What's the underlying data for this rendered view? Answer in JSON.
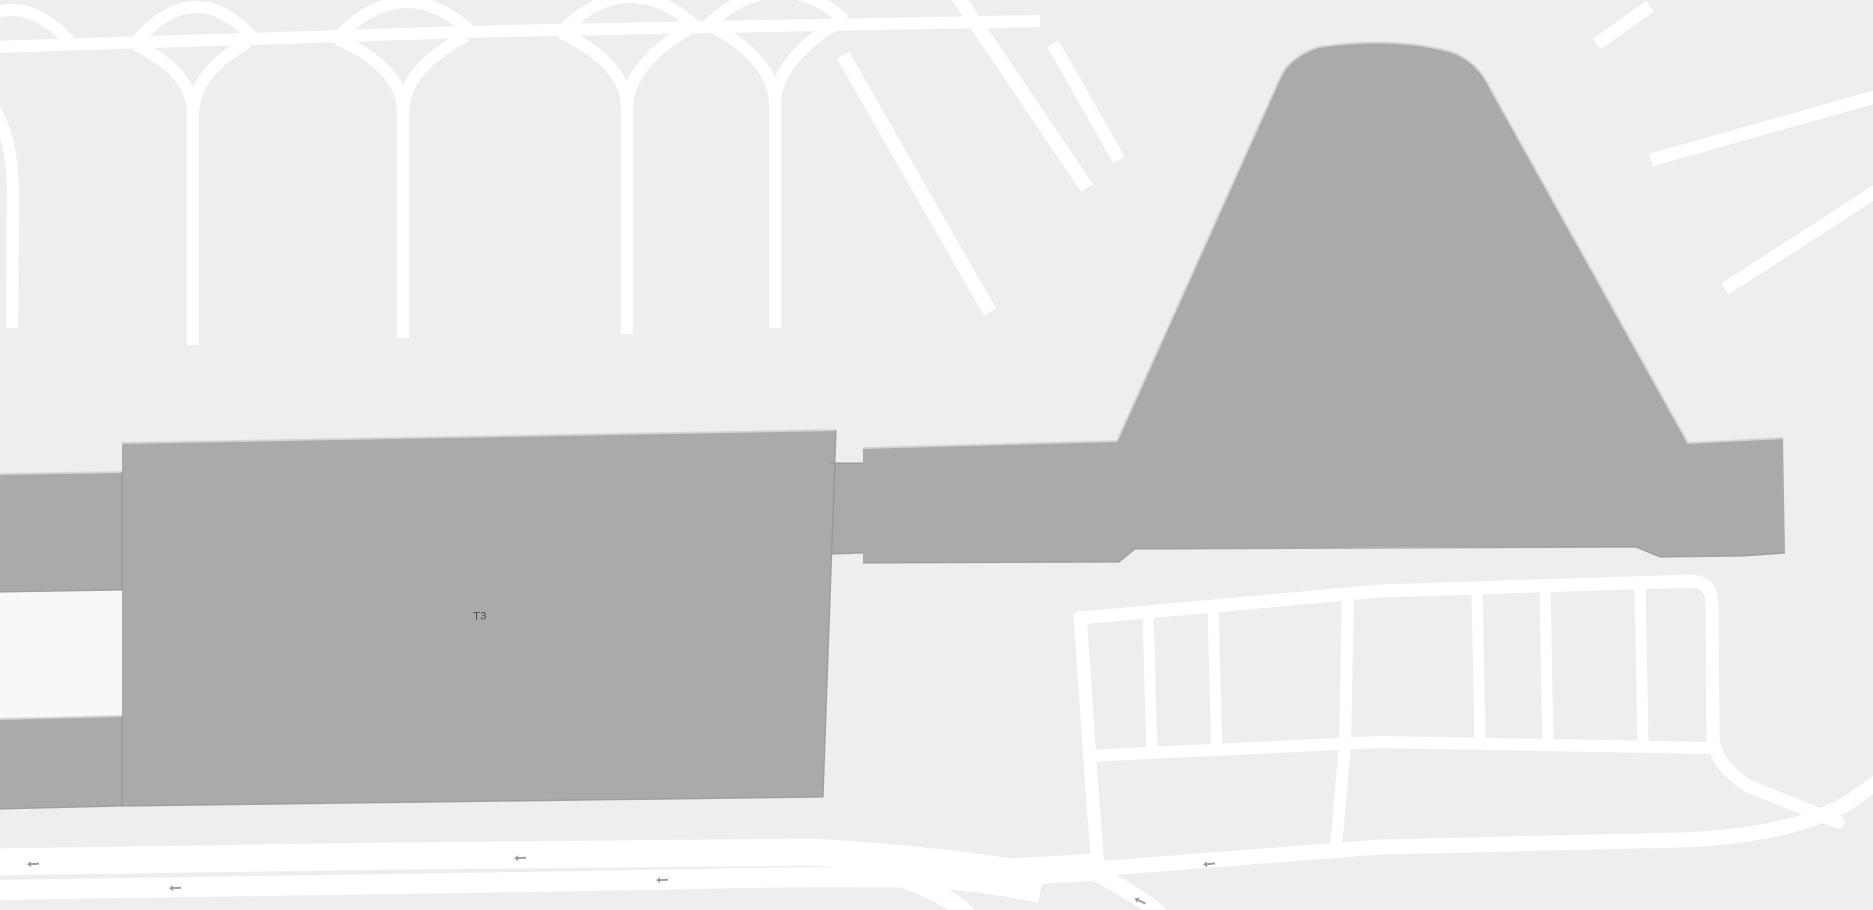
{
  "map": {
    "type": "street-map-airport",
    "labels": {
      "terminal": {
        "text": "T3",
        "x": 480,
        "y": 617
      }
    },
    "colors": {
      "background": "#edefef",
      "building": "#a9aaaa",
      "road": "#ffffff",
      "apron": "#f7f8f8",
      "seam": "#8e9191",
      "edge_highlight": "#d4d6d6",
      "arrow": "#9aa0a2",
      "label": "#4a4a4a"
    },
    "icons": {
      "oneway_arrow": "oneway-arrow-icon"
    },
    "oneway_arrows": [
      {
        "x": 33,
        "y": 864,
        "rot": -2
      },
      {
        "x": 520,
        "y": 858,
        "rot": -2
      },
      {
        "x": 175,
        "y": 888,
        "rot": -2
      },
      {
        "x": 662,
        "y": 880,
        "rot": -2
      },
      {
        "x": 1209,
        "y": 864,
        "rot": -6
      },
      {
        "x": 1140,
        "y": 901,
        "rot": 25
      }
    ],
    "features": {
      "buildings": [
        "terminal-3",
        "terminal-3-connector",
        "east-terminal-complex",
        "west-pier-a",
        "west-pier-b"
      ],
      "roads": [
        "taxiway-network",
        "runway-line",
        "diagonal-taxiways",
        "terminal-frontage-roads",
        "parking-lot-roads",
        "perimeter-road"
      ]
    }
  }
}
